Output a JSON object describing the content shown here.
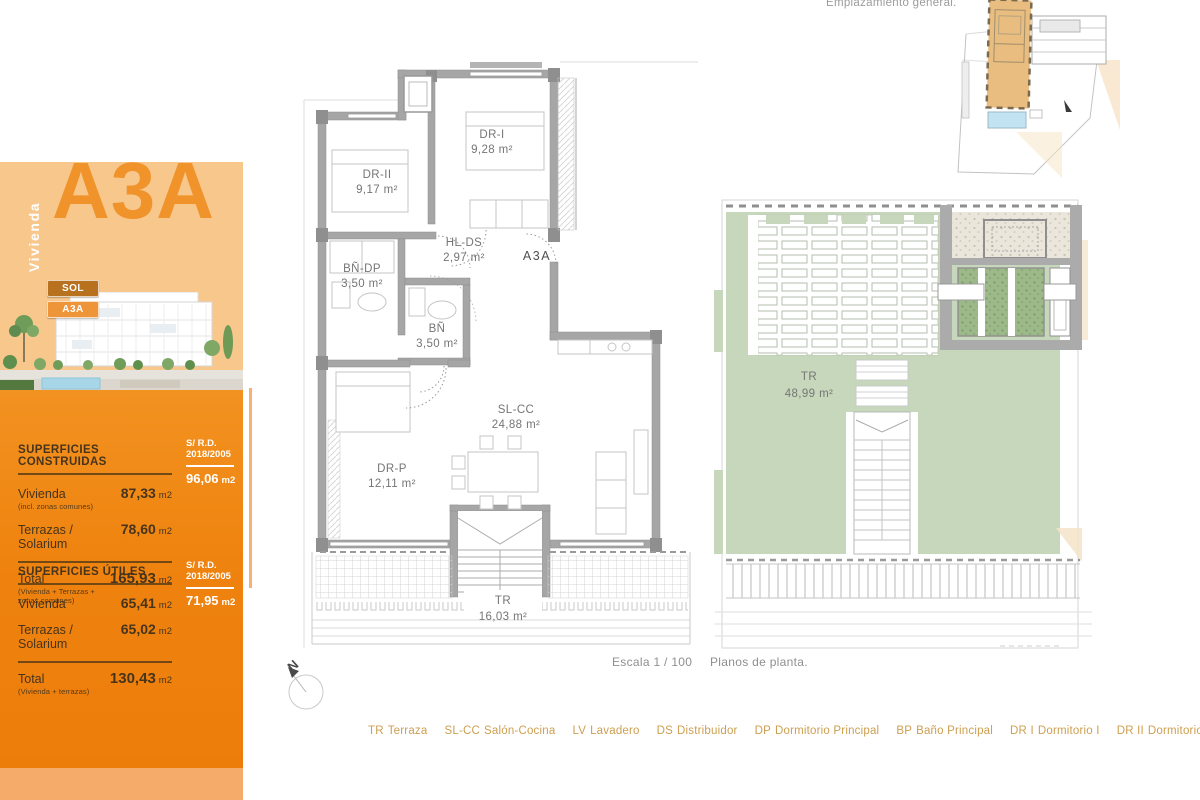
{
  "sidebar": {
    "vivienda_label": "Vivienda",
    "unit_code": "A3A",
    "badges": {
      "top": "SOL",
      "bottom": "A3A"
    },
    "tables": [
      {
        "title": "SUPERFICIES CONSTRUIDAS",
        "alt_header_line1": "S/ R.D.",
        "alt_header_line2": "2018/2005",
        "rows": [
          {
            "label": "Vivienda",
            "sublabel": "(incl. zonas comunes)",
            "value": "87,33",
            "unit": "m2",
            "alt_value": "96,06",
            "alt_unit": "m2"
          },
          {
            "label": "Terrazas / Solarium",
            "value": "78,60",
            "unit": "m2"
          },
          {
            "label": "Total",
            "sublabel": "(Vivienda + Terrazas + zonas comunes)",
            "value": "165,93",
            "unit": "m2"
          }
        ]
      },
      {
        "title": "SUPERFICIES ÚTILES",
        "alt_header_line1": "S/ R.D.",
        "alt_header_line2": "2018/2005",
        "rows": [
          {
            "label": "Vivienda",
            "value": "65,41",
            "unit": "m2",
            "alt_value": "71,95",
            "alt_unit": "m2"
          },
          {
            "label": "Terrazas / Solarium",
            "value": "65,02",
            "unit": "m2"
          },
          {
            "label": "Total",
            "sublabel": "(Vivienda + terrazas)",
            "value": "130,43",
            "unit": "m2"
          }
        ]
      }
    ]
  },
  "site_plan": {
    "title": "Emplazamiento general."
  },
  "main_plan": {
    "unit_label": "A3A",
    "north_label": "N",
    "rooms": [
      {
        "code": "DR-II",
        "area": "9,17 m²"
      },
      {
        "code": "DR-I",
        "area": "9,28 m²"
      },
      {
        "code": "HL-DS",
        "area": "2,97 m²"
      },
      {
        "code": "BÑ-DP",
        "area": "3,50 m²"
      },
      {
        "code": "BÑ",
        "area": "3,50 m²"
      },
      {
        "code": "SL-CC",
        "area": "24,88 m²"
      },
      {
        "code": "DR-P",
        "area": "12,11 m²"
      },
      {
        "code": "TR",
        "area": "16,03 m²"
      }
    ]
  },
  "roof_plan": {
    "rooms": [
      {
        "code": "TR",
        "area": "48,99 m²"
      }
    ]
  },
  "footer": {
    "scale": "Escala 1 / 100",
    "caption": "Planos de planta.",
    "legend": [
      {
        "abbr": "TR",
        "name": "Terraza"
      },
      {
        "abbr": "SL-CC",
        "name": "Salón-Cocina"
      },
      {
        "abbr": "LV",
        "name": "Lavadero"
      },
      {
        "abbr": "DS",
        "name": "Distribuidor"
      },
      {
        "abbr": "DP",
        "name": "Dormitorio Principal"
      },
      {
        "abbr": "BP",
        "name": "Baño Principal"
      },
      {
        "abbr": "DR I",
        "name": "Dormitorio I"
      },
      {
        "abbr": "DR II",
        "name": "Dormitorio II"
      },
      {
        "abbr": "BÑ",
        "name": "Baño"
      },
      {
        "abbr": "JR",
        "name": "Jardín"
      }
    ]
  },
  "colors": {
    "accent_orange": "#EF830F",
    "peach": "#F8C78C",
    "unit_orange": "#F0932B",
    "legend_gold": "#CD9F50",
    "plan_wall_gray": "#A6A6A6",
    "sage_green": "#C7D7BB",
    "moss_green": "#9DB98A",
    "pool_blue": "#A7D6E8"
  }
}
